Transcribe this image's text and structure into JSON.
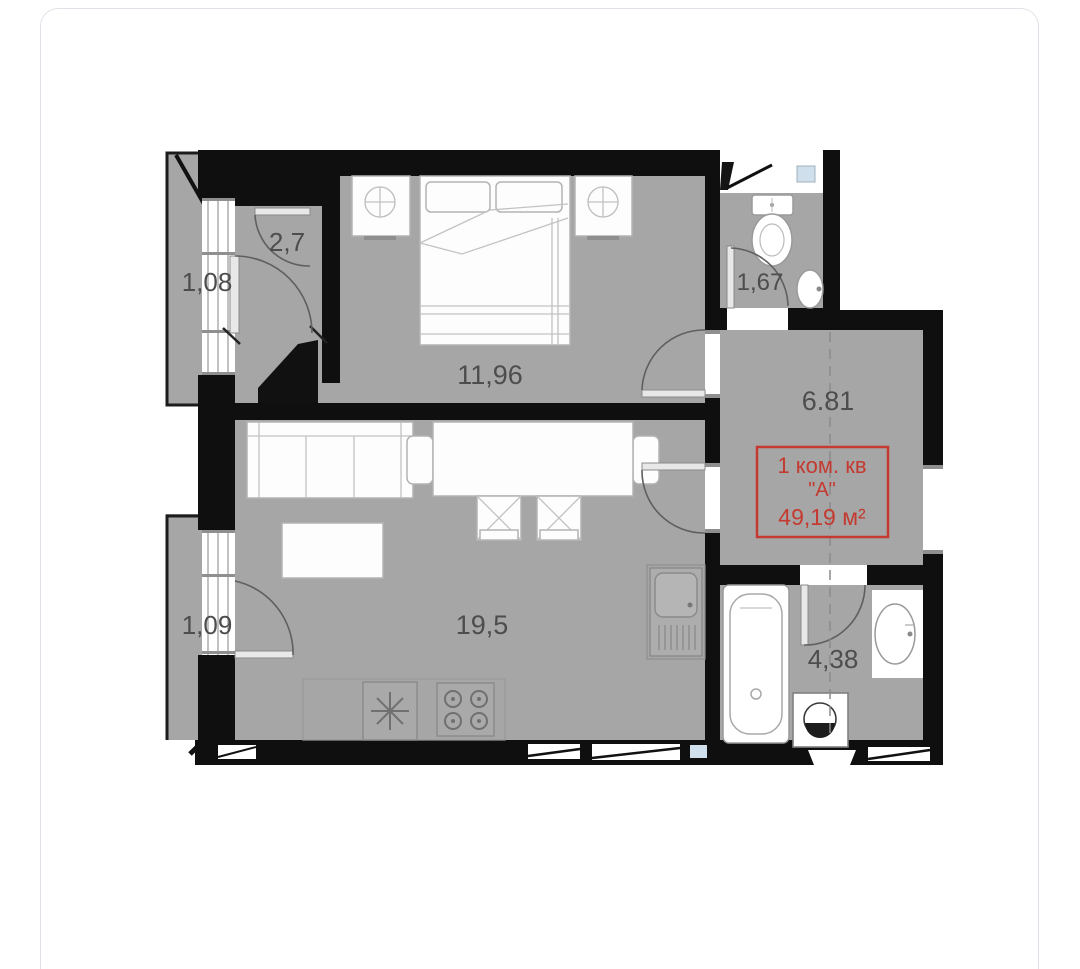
{
  "plan": {
    "unit_label": {
      "line1": "1 ком. кв",
      "line2": "\"А\"",
      "line3": "49,19 м²"
    },
    "rooms": {
      "balcony_top": {
        "area": "1,08"
      },
      "entry": {
        "area": "2,7"
      },
      "bedroom": {
        "area": "11,96"
      },
      "wc": {
        "area": "1,67"
      },
      "hallway": {
        "area": "6.81"
      },
      "living": {
        "area": "19,5"
      },
      "balcony_bottom": {
        "area": "1,09"
      },
      "bathroom": {
        "area": "4,38"
      }
    },
    "colors": {
      "wall": "#0f0f0f",
      "floor": "#a6a6a6",
      "accent_red": "#c43a30",
      "window_glass": "#cfe0ec"
    }
  }
}
